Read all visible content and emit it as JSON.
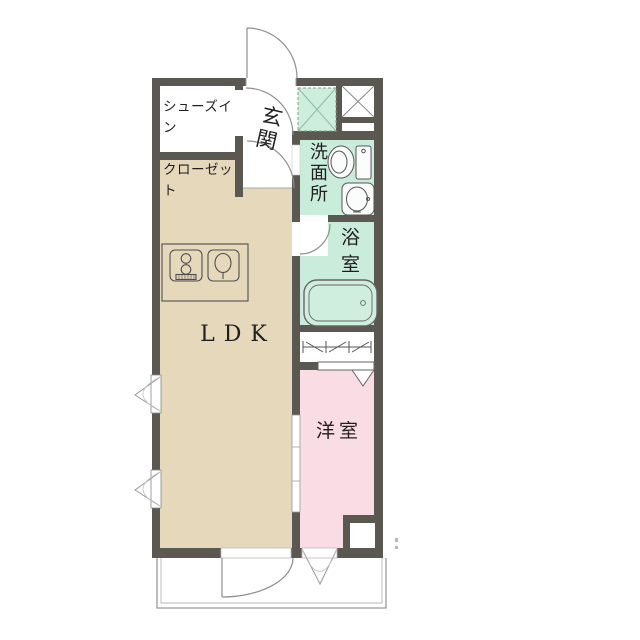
{
  "plan": {
    "title": "1LDK apartment floor plan",
    "rooms": {
      "shoes_in_closet": {
        "line1": "シューズイン",
        "line2": "クローゼット"
      },
      "entrance": {
        "label": "玄関"
      },
      "washroom": {
        "label": "洗面所"
      },
      "bathroom": {
        "label": "浴室"
      },
      "ldk": {
        "label": "LDK"
      },
      "western_room": {
        "label": "洋室"
      }
    },
    "icons": {
      "entrance_door": "door-swing-icon",
      "shoes_closet_door": "door-swing-icon",
      "ldk_door": "door-swing-icon",
      "bathroom_door": "door-swing-icon",
      "balcony_door": "door-swing-icon",
      "western_room_balcony_window": "casement-window-icon",
      "left_wall_windows": "casement-window-icon",
      "sliding_door": "sliding-door-icon",
      "closet_hanger": "hanger-pipe-icon",
      "closet_door": "folding-door-icon",
      "entrance_tile": "tile-x-icon",
      "shaft": "shaft-x-icon",
      "toilet": "toilet-icon",
      "washbasin": "washbasin-icon",
      "bathtub": "bathtub-icon",
      "stove": "stove-icon",
      "kitchen_sink": "kitchen-sink-icon"
    },
    "colors": {
      "wall": "#5b5751",
      "ldk_floor": "#e6d8bb",
      "western_room_floor": "#f9dce4",
      "wet_area_floor": "#c9ecdb",
      "entrance_tile": "#cdeedd",
      "outline": "#999999",
      "text": "#1f1f1f",
      "background": "#ffffff"
    }
  }
}
